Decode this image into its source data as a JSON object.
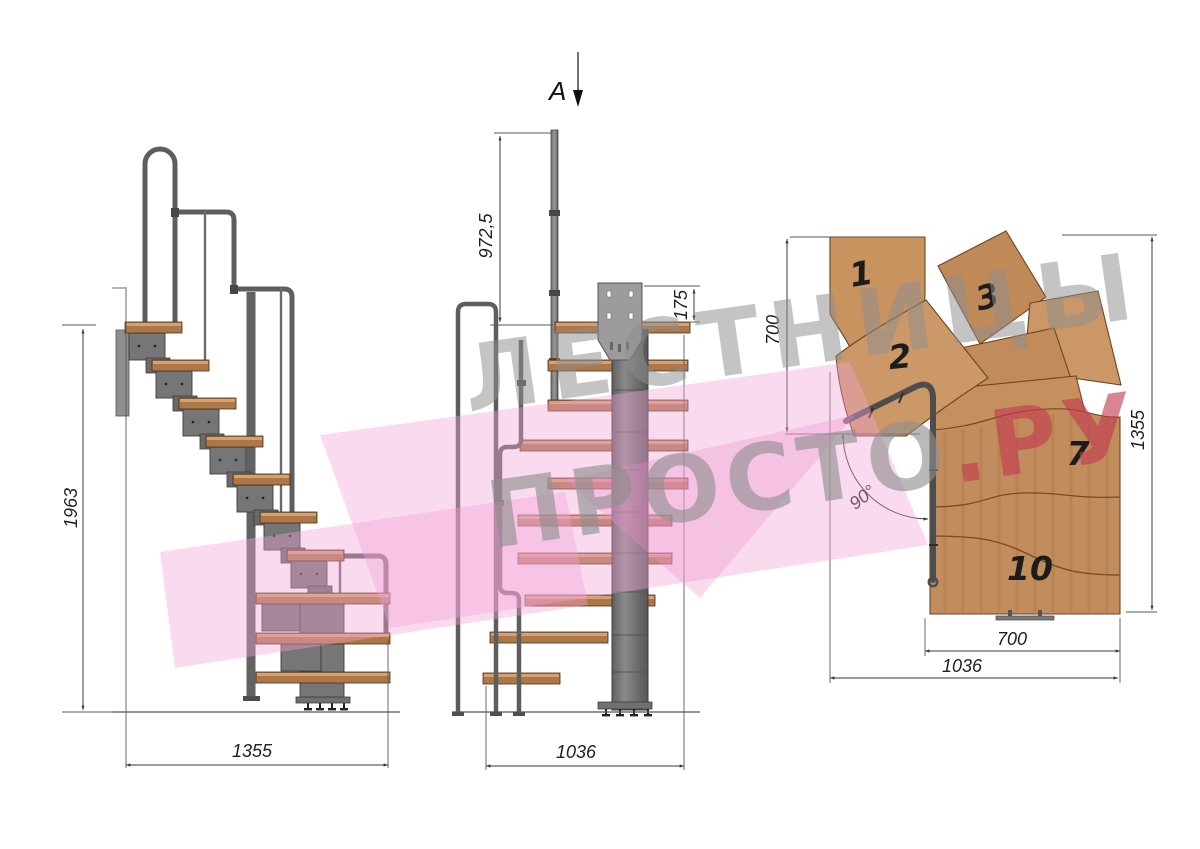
{
  "watermark": {
    "line1": "ЛЕСТНИЦЫ",
    "line2_gray": "ПРОСТО",
    "line2_red": ".РУ"
  },
  "section_marker": {
    "label": "A"
  },
  "side_view": {
    "dims": {
      "height": "1963",
      "width": "1355"
    }
  },
  "front_view": {
    "dims": {
      "rail_post_height": "972,5",
      "plate_height": "175",
      "width": "1036"
    }
  },
  "plan_view": {
    "dims": {
      "upper_flight_depth": "700",
      "total_depth": "1355",
      "lower_flight_width": "700",
      "total_width": "1036",
      "turn_angle": "90°"
    },
    "tread_numbers": [
      "1",
      "2",
      "3",
      "7",
      "10"
    ]
  },
  "colors": {
    "wood_side": "#ad7747",
    "wood_plan": "#c28d5c",
    "steel": "#767676",
    "dimension_line": "#3a3a3a",
    "watermark_gray": "#8f8f8f",
    "watermark_red": "#c23a52",
    "watermark_pink": "#f2a3d6"
  }
}
